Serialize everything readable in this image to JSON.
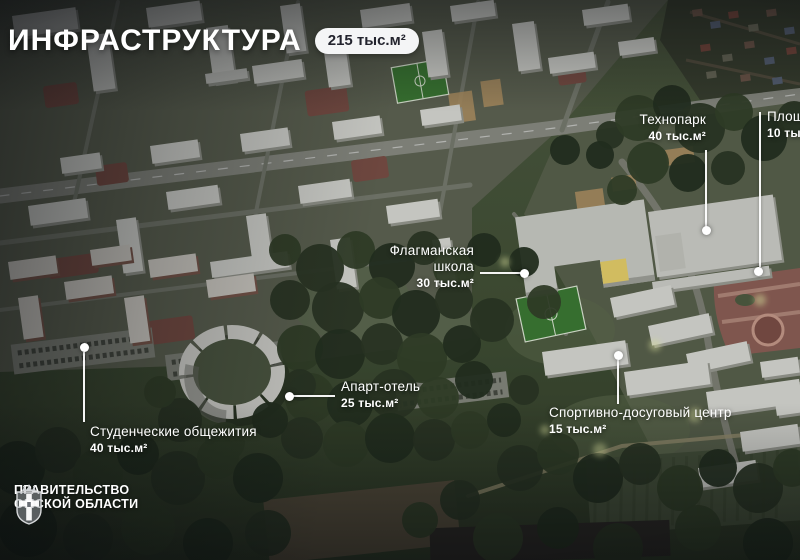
{
  "header": {
    "title": "ИНФРАСТРУКТУРА",
    "badge": "215 тыс.м²"
  },
  "annotations": [
    {
      "name": "Технопарк",
      "area": "40 тыс.м²"
    },
    {
      "name": "Площадь",
      "area": "10 тыс.м²"
    },
    {
      "name": "Флагманская школа",
      "area": "30 тыс.м²"
    },
    {
      "name": "Апарт-отель",
      "area": "25 тыс.м²"
    },
    {
      "name": "Спортивно-досуговый центр",
      "area": "15 тыс.м²"
    },
    {
      "name": "Студенческие общежития",
      "area": "40 тыс.м²"
    }
  ],
  "footer": {
    "org_line1": "ПРАВИТЕЛЬСТВО",
    "org_line2": "ОМСКОЙ ОБЛАСТИ"
  },
  "colors": {
    "badge_bg": "#f4f5f6",
    "badge_text": "#23242e",
    "label_text": "#ffffff"
  }
}
